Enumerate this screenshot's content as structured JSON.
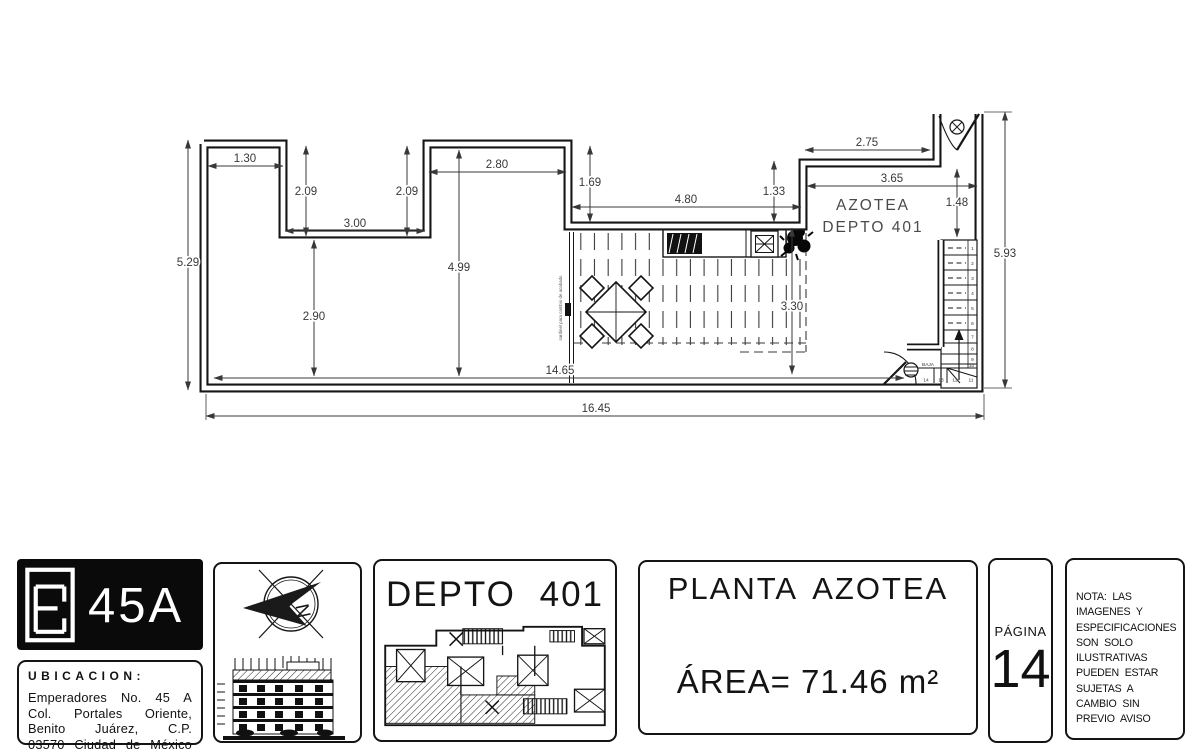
{
  "colors": {
    "line": "#161616",
    "dim_text": "#383838",
    "room_text": "#4a4a4a"
  },
  "plan": {
    "room_label_line1": "AZOTEA",
    "room_label_line2": "DEPTO 401",
    "deck_note": "sardinel para cambio de acabado",
    "dimensions": [
      "1.30",
      "2.09",
      "2.09",
      "3.00",
      "2.80",
      "5.29",
      "4.99",
      "2.90",
      "1.69",
      "4.80",
      "1.33",
      "2.75",
      "3.65",
      "1.48",
      "3.30",
      "14.65",
      "16.45",
      "5.93"
    ],
    "stairs": {
      "baja_label": "BAJA",
      "treads": [
        "1",
        "2",
        "3",
        "4",
        "5",
        "6",
        "7",
        "8",
        "9",
        "10",
        "11",
        "12",
        "13",
        "14"
      ]
    }
  },
  "titleblock": {
    "logo_text": "45A",
    "ubicacion_label": "UBICACION:",
    "address_lines": [
      "Emperadores No. 45 A",
      "Col. Portales Oriente,",
      "Benito Juárez, C.P.",
      "03570 Ciudad de México"
    ],
    "compass_letter": "N",
    "unit_title": "DEPTO 401",
    "plan_name": "PLANTA AZOTEA",
    "area_text": "ÁREA= 71.46 m²",
    "page_label": "PÁGINA",
    "page_number": "14",
    "nota_lines": [
      "NOTA: LAS",
      "IMAGENES Y",
      "ESPECIFICACIONES",
      "SON SOLO",
      "ILUSTRATIVAS",
      "PUEDEN ESTAR",
      "SUJETAS A",
      "CAMBIO SIN",
      "PREVIO AVISO"
    ]
  }
}
